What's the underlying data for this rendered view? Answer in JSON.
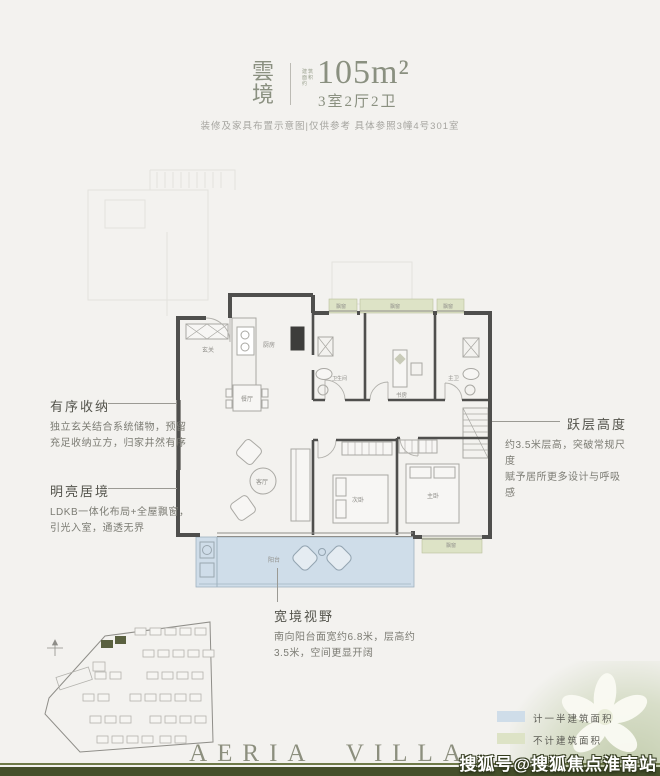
{
  "header": {
    "title_line1": "雲",
    "title_line2": "境",
    "area_label_line1": "建筑",
    "area_label_line2": "面积约",
    "area_value": "105m²",
    "unit_layout": "3室2厅2卫",
    "note": "装修及家具布置示意图|仅供参考 具体参照3幢4号301室"
  },
  "floorplan": {
    "rooms": {
      "entry": "玄关",
      "kitchen": "厨房",
      "dining": "餐厅",
      "living": "客厅",
      "bathroom": "卫生间",
      "study": "书房",
      "master_bath": "主卫",
      "second_bedroom": "次卧",
      "master_bedroom": "主卧",
      "balcony": "阳台",
      "bay_window": "飘窗"
    },
    "colors": {
      "wall": "#4f4f4d",
      "bay_window_fill": "#dde3c6",
      "balcony_fill": "#cfdde9"
    }
  },
  "annotations": {
    "storage": {
      "title": "有序收纳",
      "line1": "独立玄关结合系统储物，预留",
      "line2": "充足收纳立方，归家井然有序"
    },
    "bright": {
      "title": "明亮居境",
      "line1": "LDKB一体化布局+全屋飘窗，",
      "line2": "引光入室，通透无界"
    },
    "view": {
      "title": "宽境视野",
      "line1": "南向阳台面宽约6.8米，层高约",
      "line2": "3.5米，空间更显开阔"
    },
    "loft": {
      "title": "跃层高度",
      "line1": "约3.5米层高，突破常规尺度",
      "line2": "赋予居所更多设计与呼吸感"
    }
  },
  "legend": {
    "items": [
      {
        "label": "计一半建筑面积",
        "color": "#cfdde9"
      },
      {
        "label": "不计建筑面积",
        "color": "#dde3c6"
      }
    ]
  },
  "footer": {
    "brand": "AERIA VILLA",
    "watermark": "搜狐号@搜狐焦点淮南站"
  }
}
